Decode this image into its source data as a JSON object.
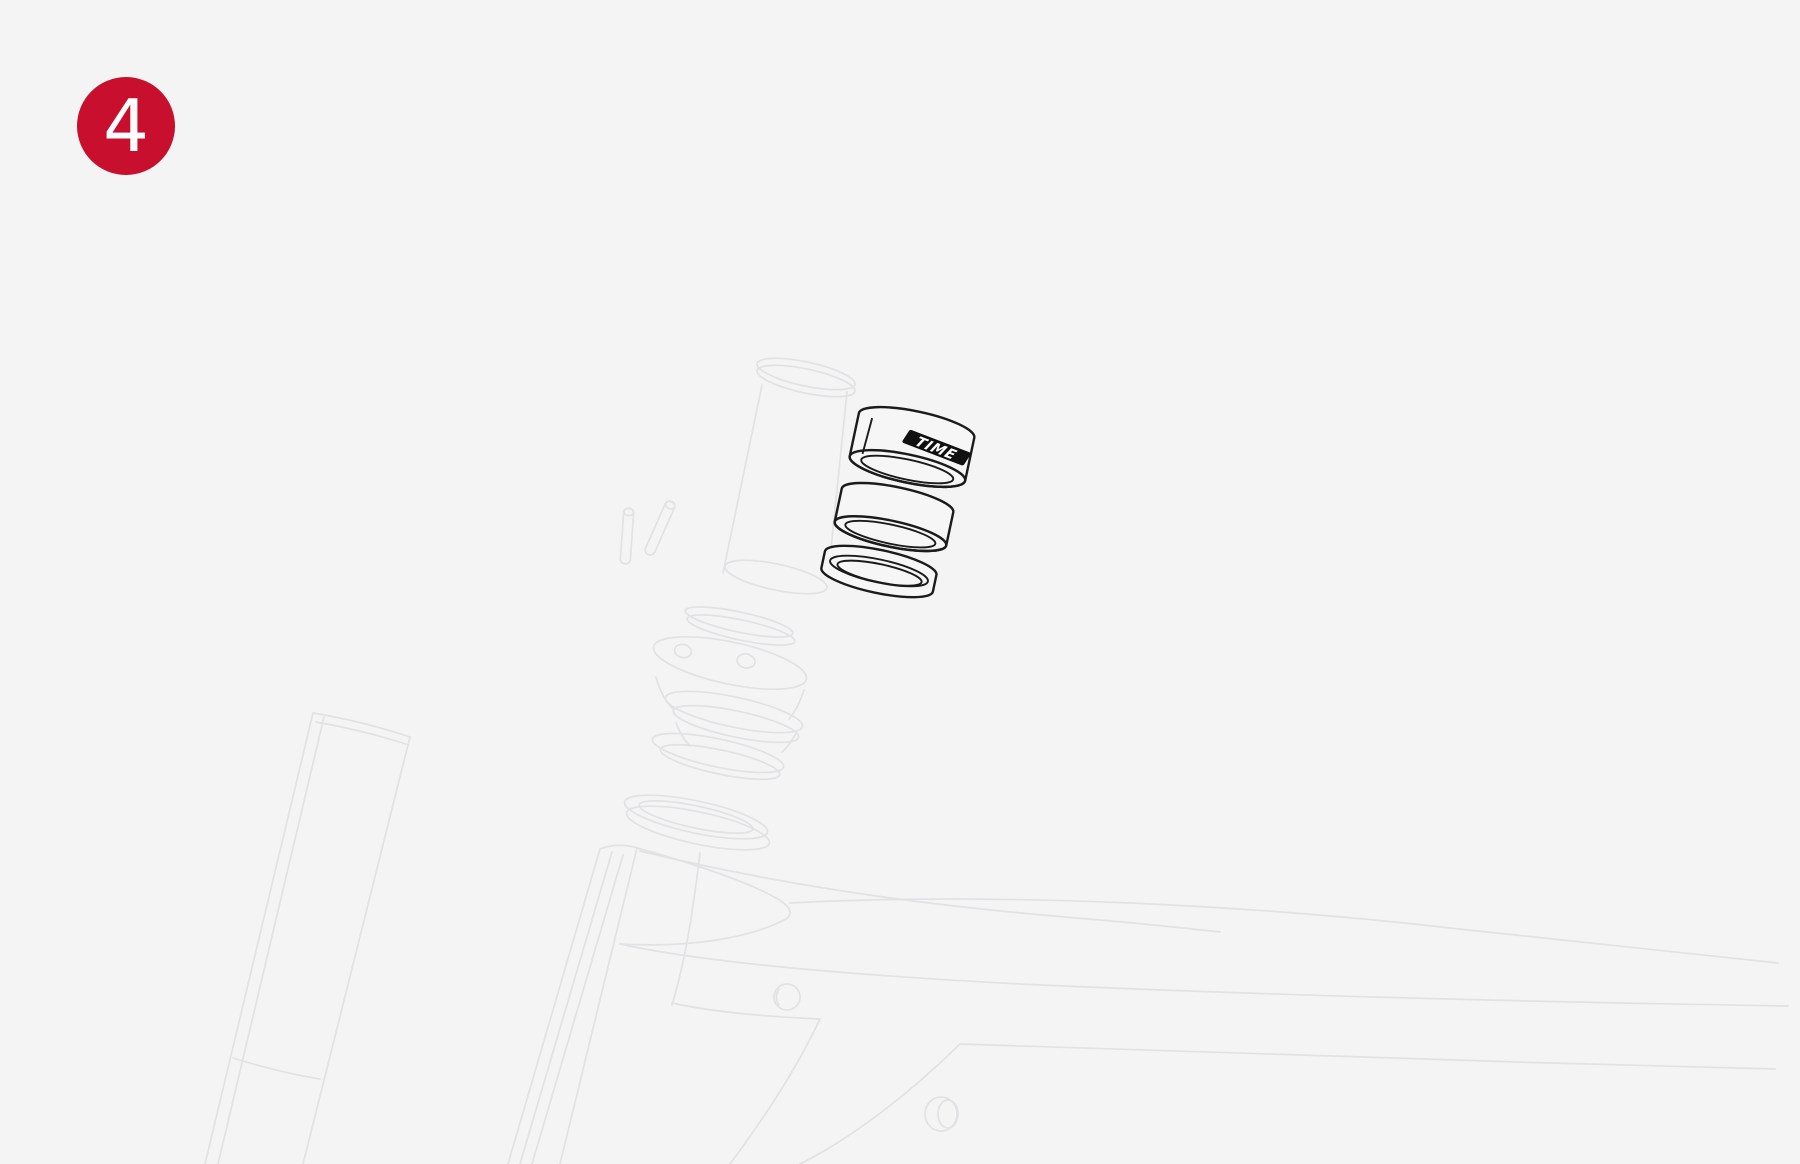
{
  "badge": {
    "number": "4"
  },
  "spacers": {
    "logo_text": "TIME"
  },
  "colors": {
    "background": "#f4f4f4",
    "badge_red": "#c8102e",
    "badge_text": "#ffffff",
    "line_dark": "#1b1b1b",
    "line_faint": "#e2e2e5",
    "logo_band": "#111111",
    "logo_text_color": "#ffffff"
  },
  "parts": [
    "step-badge",
    "steerer-tube-outline",
    "clamp-pins-outline",
    "headset-top-cap-outline",
    "headset-bearing-outline",
    "spacer-top",
    "spacer-middle",
    "spacer-bottom-ring",
    "fork-leg-outline",
    "frame-outline"
  ]
}
